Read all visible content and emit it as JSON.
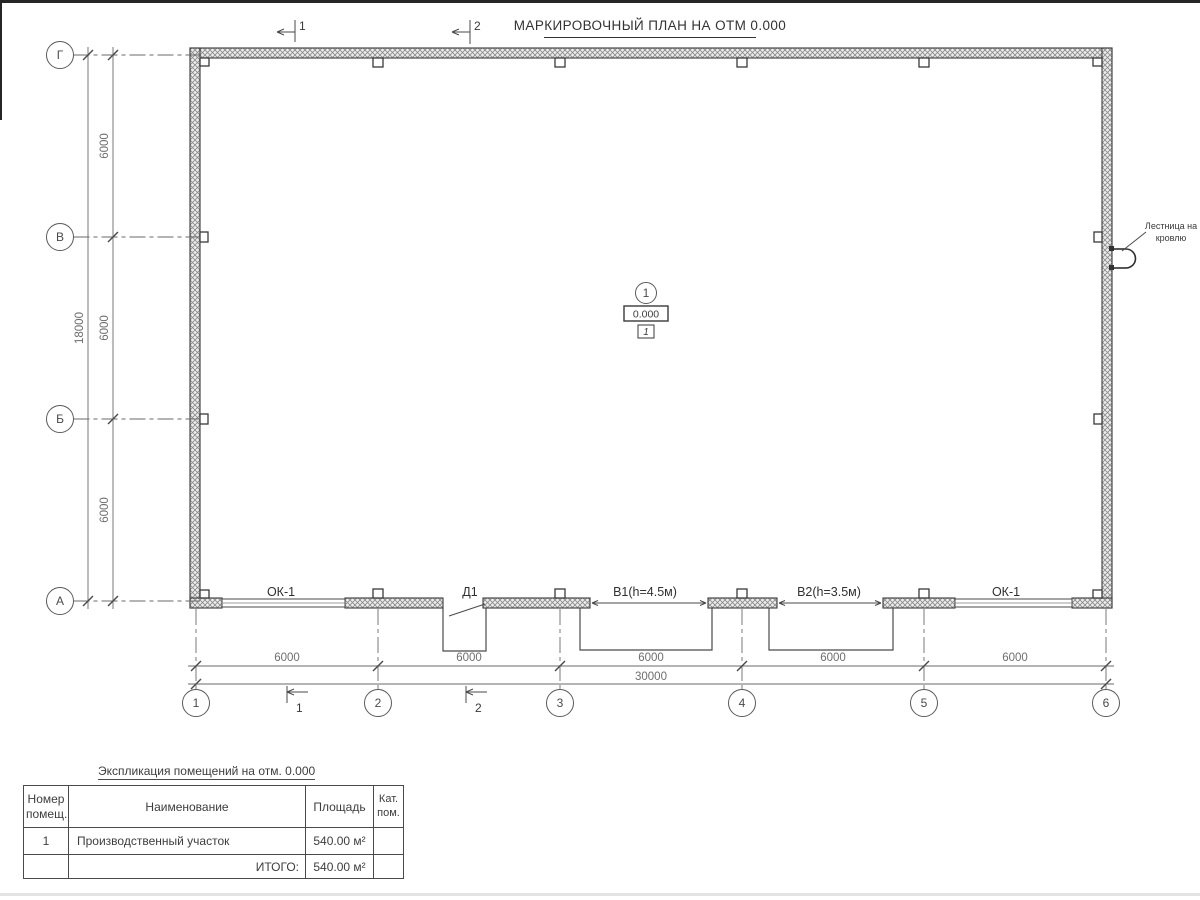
{
  "title": "МАРКИРОВОЧНЫЙ ПЛАН НА ОТМ 0.000",
  "plan": {
    "row_axes": [
      "Г",
      "В",
      "Б",
      "А"
    ],
    "col_axes": [
      "1",
      "2",
      "3",
      "4",
      "5",
      "6"
    ],
    "left_dim_segments": [
      "6000",
      "6000",
      "6000"
    ],
    "left_dim_total": "18000",
    "bottom_dim_segments": [
      "6000",
      "6000",
      "6000",
      "6000",
      "6000"
    ],
    "bottom_dim_total": "30000",
    "opening_labels": [
      "ОК-1",
      "Д1",
      "В1(h=4.5м)",
      "В2(h=3.5м)",
      "ОК-1"
    ],
    "section_mark_1": "1",
    "section_mark_2": "2",
    "room_marker": {
      "number": "1",
      "elevation": "0.000",
      "type_tag": "1"
    },
    "ladder_note": {
      "line1": "Лестница на",
      "line2": "кровлю"
    }
  },
  "schedule": {
    "title": "Экспликация помещений на отм. 0.000",
    "headers": {
      "number": "Номер\nпомещ.",
      "name": "Наименование",
      "area": "Площадь",
      "category": "Кат.\nпом."
    },
    "rows": [
      {
        "number": "1",
        "name": "Производственный участок",
        "area": "540.00 м²",
        "category": ""
      }
    ],
    "total": {
      "label": "ИТОГО:",
      "area": "540.00 м²"
    }
  }
}
